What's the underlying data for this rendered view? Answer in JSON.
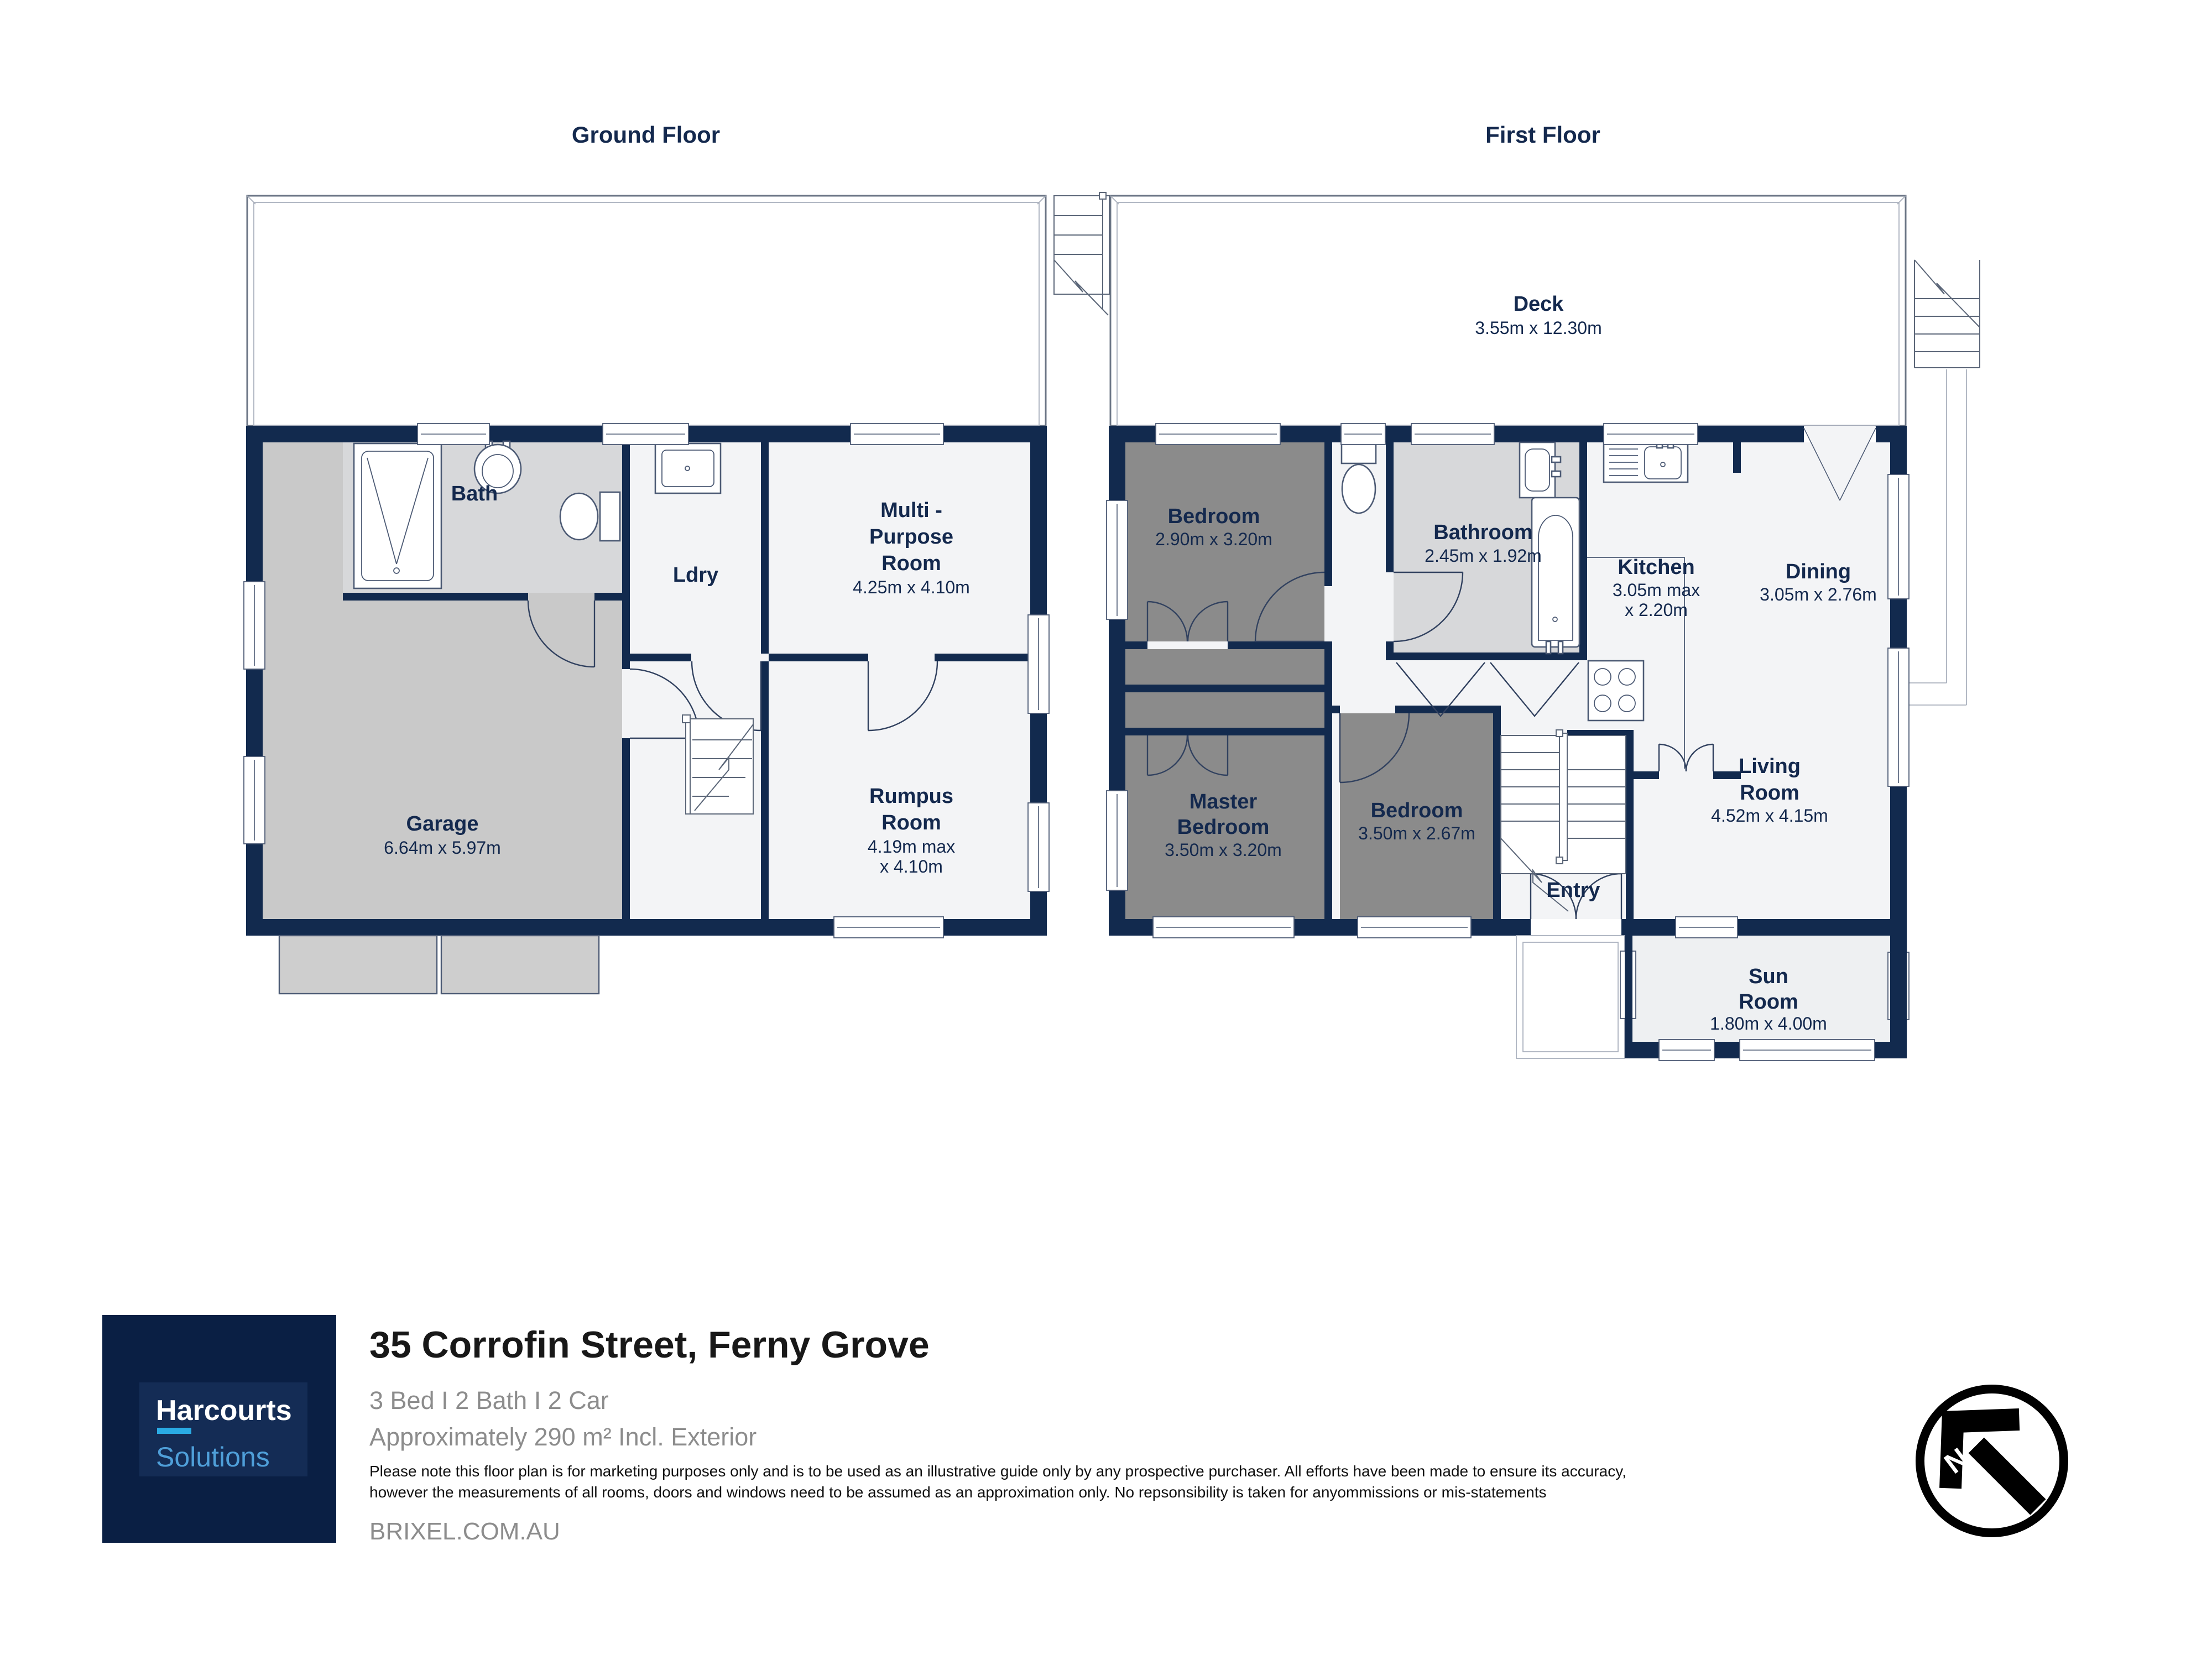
{
  "ground": {
    "title": "Ground Floor",
    "bath": "Bath",
    "ldry": "Ldry",
    "mpr_1": "Multi -",
    "mpr_2": "Purpose",
    "mpr_3": "Room",
    "mpr_dims": "4.25m x 4.10m",
    "garage": "Garage",
    "garage_dims": "6.64m x 5.97m",
    "rumpus_1": "Rumpus",
    "rumpus_2": "Room",
    "rumpus_dims_1": "4.19m max",
    "rumpus_dims_2": "x 4.10m"
  },
  "first": {
    "title": "First Floor",
    "deck": "Deck",
    "deck_dims": "3.55m x 12.30m",
    "bedroom1": "Bedroom",
    "bedroom1_dims": "2.90m x 3.20m",
    "bathroom": "Bathroom",
    "bathroom_dims": "2.45m x 1.92m",
    "kitchen": "Kitchen",
    "kitchen_dims_1": "3.05m max",
    "kitchen_dims_2": "x 2.20m",
    "dining": "Dining",
    "dining_dims": "3.05m x 2.76m",
    "master_1": "Master",
    "master_2": "Bedroom",
    "master_dims": "3.50m x 3.20m",
    "bedroom2": "Bedroom",
    "bedroom2_dims": "3.50m x 2.67m",
    "entry": "Entry",
    "living_1": "Living",
    "living_2": "Room",
    "living_dims": "4.52m x 4.15m",
    "sun_1": "Sun",
    "sun_2": "Room",
    "sun_dims": "1.80m x 4.00m"
  },
  "brand": {
    "name": "Harcourts",
    "division": "Solutions"
  },
  "footer": {
    "address": "35 Corrofin Street, Ferny Grove",
    "summary": "3 Bed I 2 Bath I 2 Car",
    "area": "Approximately 290 m² Incl. Exterior",
    "disclaimer_1": "Please note this floor plan is for marketing purposes only and is to be used as an illustrative guide only by any prospective purchaser. All efforts have been made to ensure its accuracy,",
    "disclaimer_2": "however the measurements of all rooms, doors and windows  need to be assumed as an approximation only. No repsonsibility is taken for anyommissions or mis-statements",
    "website": "BRIXEL.COM.AU"
  },
  "compass": {
    "label": "N"
  },
  "colors": {
    "wall": "#122a4e",
    "label": "#14294e",
    "floor_light": "#f3f4f6",
    "floor_garage": "#c9c9c9",
    "floor_bath": "#d7d8da",
    "floor_bedroom": "#8b8b8b",
    "brand_bg": "#0a1f44",
    "brand_panel": "#142c55",
    "brand_accent": "#2aabe4",
    "brand_secondary": "#4f9fd9",
    "text_muted": "#8c8c8c",
    "text_dark": "#181818"
  }
}
